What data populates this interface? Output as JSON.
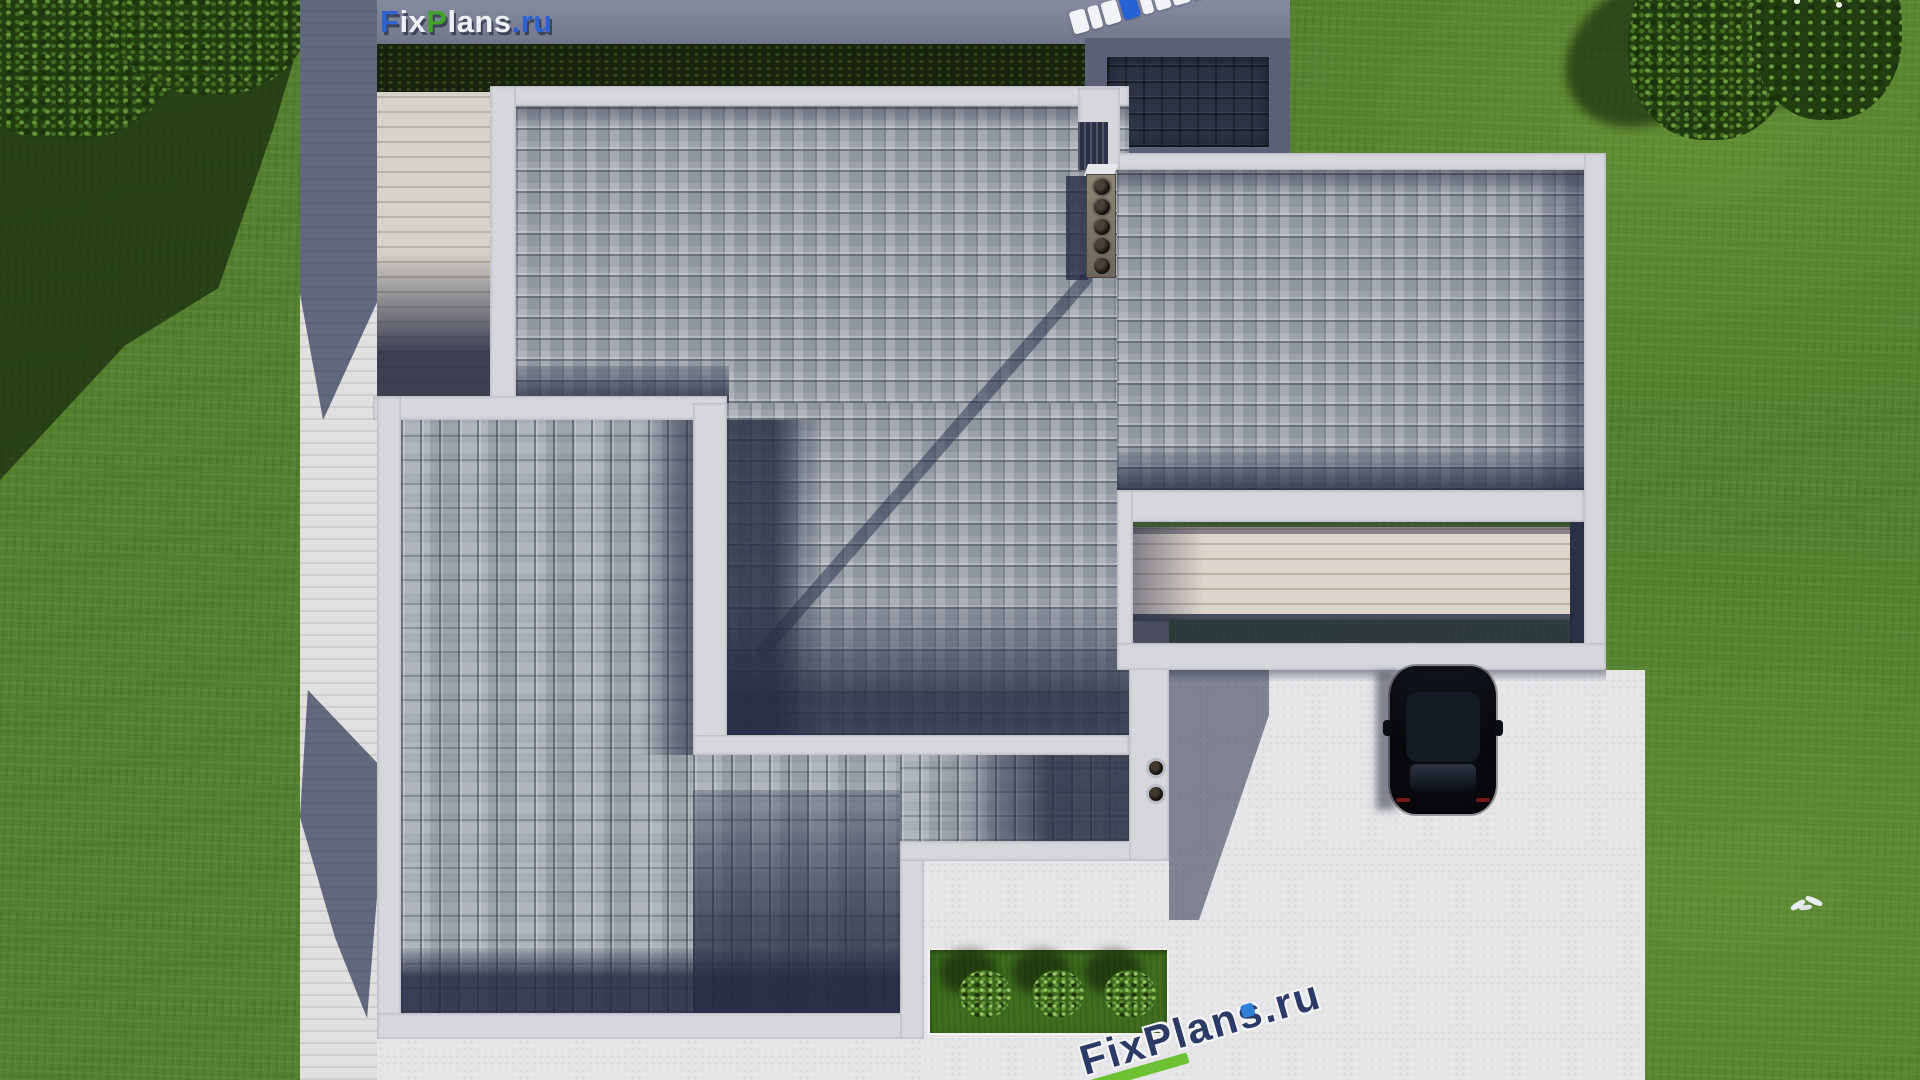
{
  "brand": {
    "logo": {
      "f": "F",
      "ix": "ix",
      "p": "P",
      "lans": "lans",
      "dot_ru": ".ru"
    },
    "colors": {
      "blue": "#2e63cf",
      "green": "#43a32a",
      "white": "#eceff3"
    }
  },
  "watermarks": {
    "top": {
      "text": "FixPlans.ru",
      "blue_letter_index": 3,
      "green_dot": true
    },
    "bottom": {
      "text": "FixPlans.ru",
      "accent_bar_color": "#6cc233",
      "dot_color": "#2f7fd4"
    }
  },
  "scene": {
    "description": "Aerial top-down 3D render of a flat-roof house plan with shingle roof, deck, pergola, driveway and garden",
    "objects": {
      "chimney_flues": 5,
      "roof_vents": 2,
      "garden_bushes": 3,
      "trees_top_right": 2,
      "cars": 1,
      "birds": 1
    },
    "colors": {
      "grass": "#55802e",
      "shingle_light": "#a4aab3",
      "shingle_shadow": "#2a3147",
      "parapet_white": "#d6d7db",
      "concrete": "#e6e6e8",
      "wood_deck": "#d8d3ca",
      "hedge": "#18220e",
      "wall_strip": "#7d8297",
      "annex_dark": "#2d3343",
      "car": "#0a0c10"
    }
  }
}
